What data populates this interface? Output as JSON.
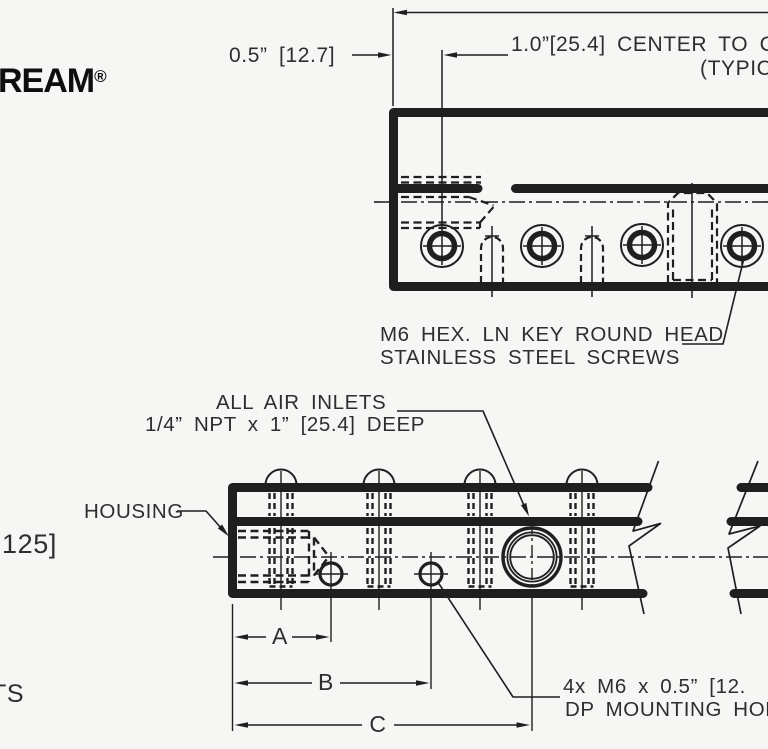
{
  "colors": {
    "background": "#f6f6f4",
    "line": "#1f1f1f",
    "text": "#2e2e2e",
    "logo": "#0e0e0e"
  },
  "logo": {
    "name": "REAM",
    "registered_mark": "®"
  },
  "top_dimensions": {
    "offset": "0.5” [12.7]",
    "center_to_center": "1.0”[25.4] CENTER TO C",
    "center_to_center_cont": "(TYPICA"
  },
  "annotations": {
    "screws_line1": "M6 HEX. LN KEY ROUND HEAD",
    "screws_line2": "STAINLESS STEEL SCREWS",
    "air_inlets_line1": "ALL AIR INLETS",
    "air_inlets_line2": "1/4” NPT x 1” [25.4] DEEP",
    "housing": "HOUSING",
    "left_edge_cut": "125]",
    "bottom_left_cut": "TS",
    "mounting_line1": "4x M6 x 0.5” [12.",
    "mounting_line2": "DP MOUNTING HOLE"
  },
  "bottom_dimensions": {
    "a": "A",
    "b": "B",
    "c": "C"
  }
}
